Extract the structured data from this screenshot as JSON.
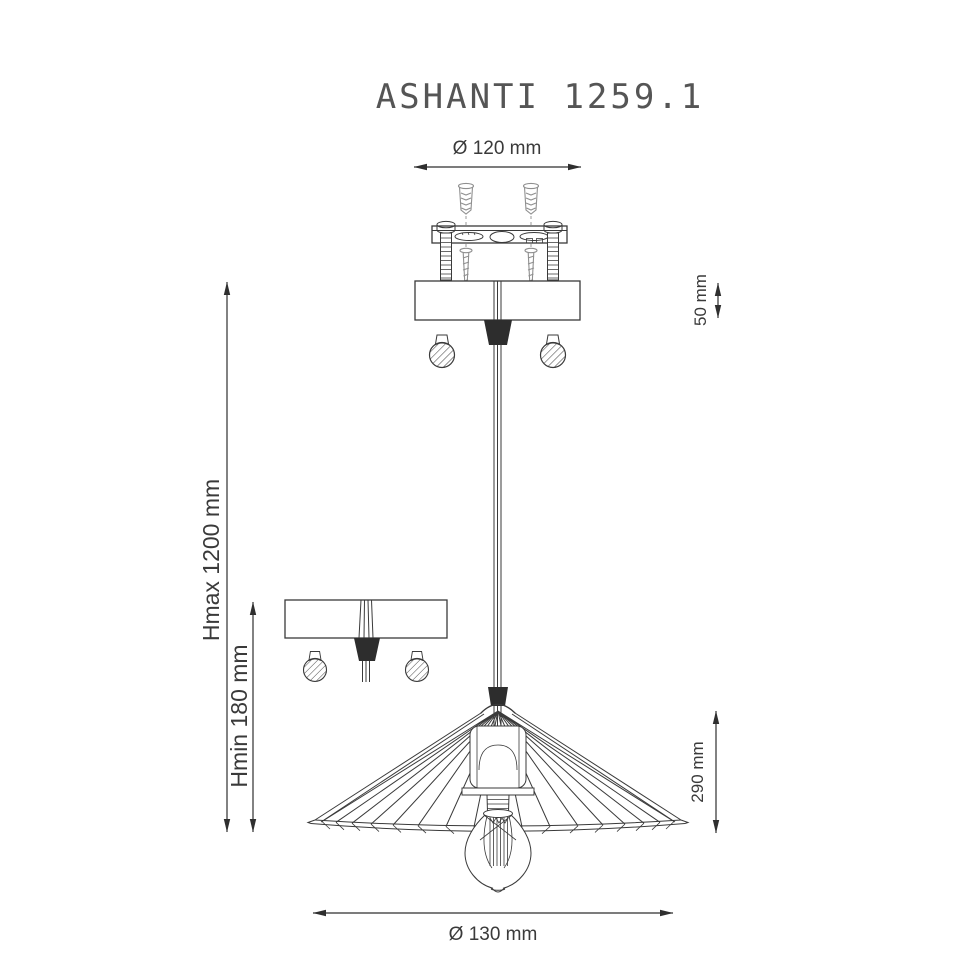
{
  "title": "ASHANTI 1259.1",
  "dimensions": {
    "top_diameter": "Ø 120 mm",
    "canopy_height": "50 mm",
    "height_max": "Hmax 1200 mm",
    "height_min": "Hmin 180 mm",
    "shade_height": "290 mm",
    "shade_diameter": "Ø 130 mm"
  },
  "colors": {
    "background": "#ffffff",
    "line": "#3a3a3a",
    "line_light": "#8f8f8f",
    "dark_fill": "#2d2d2d",
    "dim_line": "#2f2f2f",
    "text": "#3a3a3a",
    "title_text": "#555555"
  }
}
